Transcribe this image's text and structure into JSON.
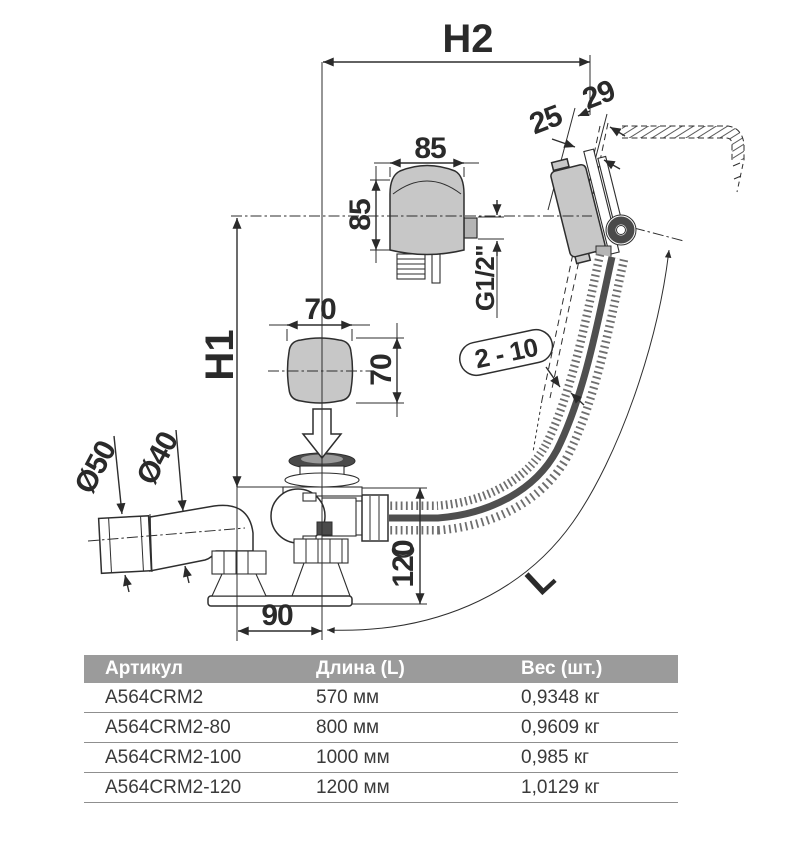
{
  "drawing": {
    "title_hint": "bath drain and overflow set side view with dimensions",
    "dims": {
      "h2": "H2",
      "h1": "H1",
      "n29": "29",
      "n25": "25",
      "w85": "85",
      "h85": "85",
      "g12": "G1/2\"",
      "w70": "70",
      "h70": "70",
      "range": "2 - 10",
      "d50": "Ø50",
      "d40": "Ø40",
      "v120": "120",
      "v90": "90",
      "length": "L"
    }
  },
  "table": {
    "headers": [
      "Артикул",
      "Длина (L)",
      "Вес (шт.)"
    ],
    "rows": [
      [
        "A564CRM2",
        "570 мм",
        "0,9348 кг"
      ],
      [
        "A564CRM2-80",
        "800 мм",
        "0,9609 кг"
      ],
      [
        "A564CRM2-100",
        "1000 мм",
        "0,985 кг"
      ],
      [
        "A564CRM2-120",
        "1200 мм",
        "1,0129 кг"
      ]
    ]
  },
  "colors": {
    "background": "#ffffff",
    "line": "#2e2e2e",
    "part_fill_light": "#c7c7c7",
    "part_fill_dark": "#4a4a4a",
    "table_header_bg": "#9b9b9b",
    "table_header_text": "#ffffff",
    "table_body_text": "#3a3a3a"
  }
}
